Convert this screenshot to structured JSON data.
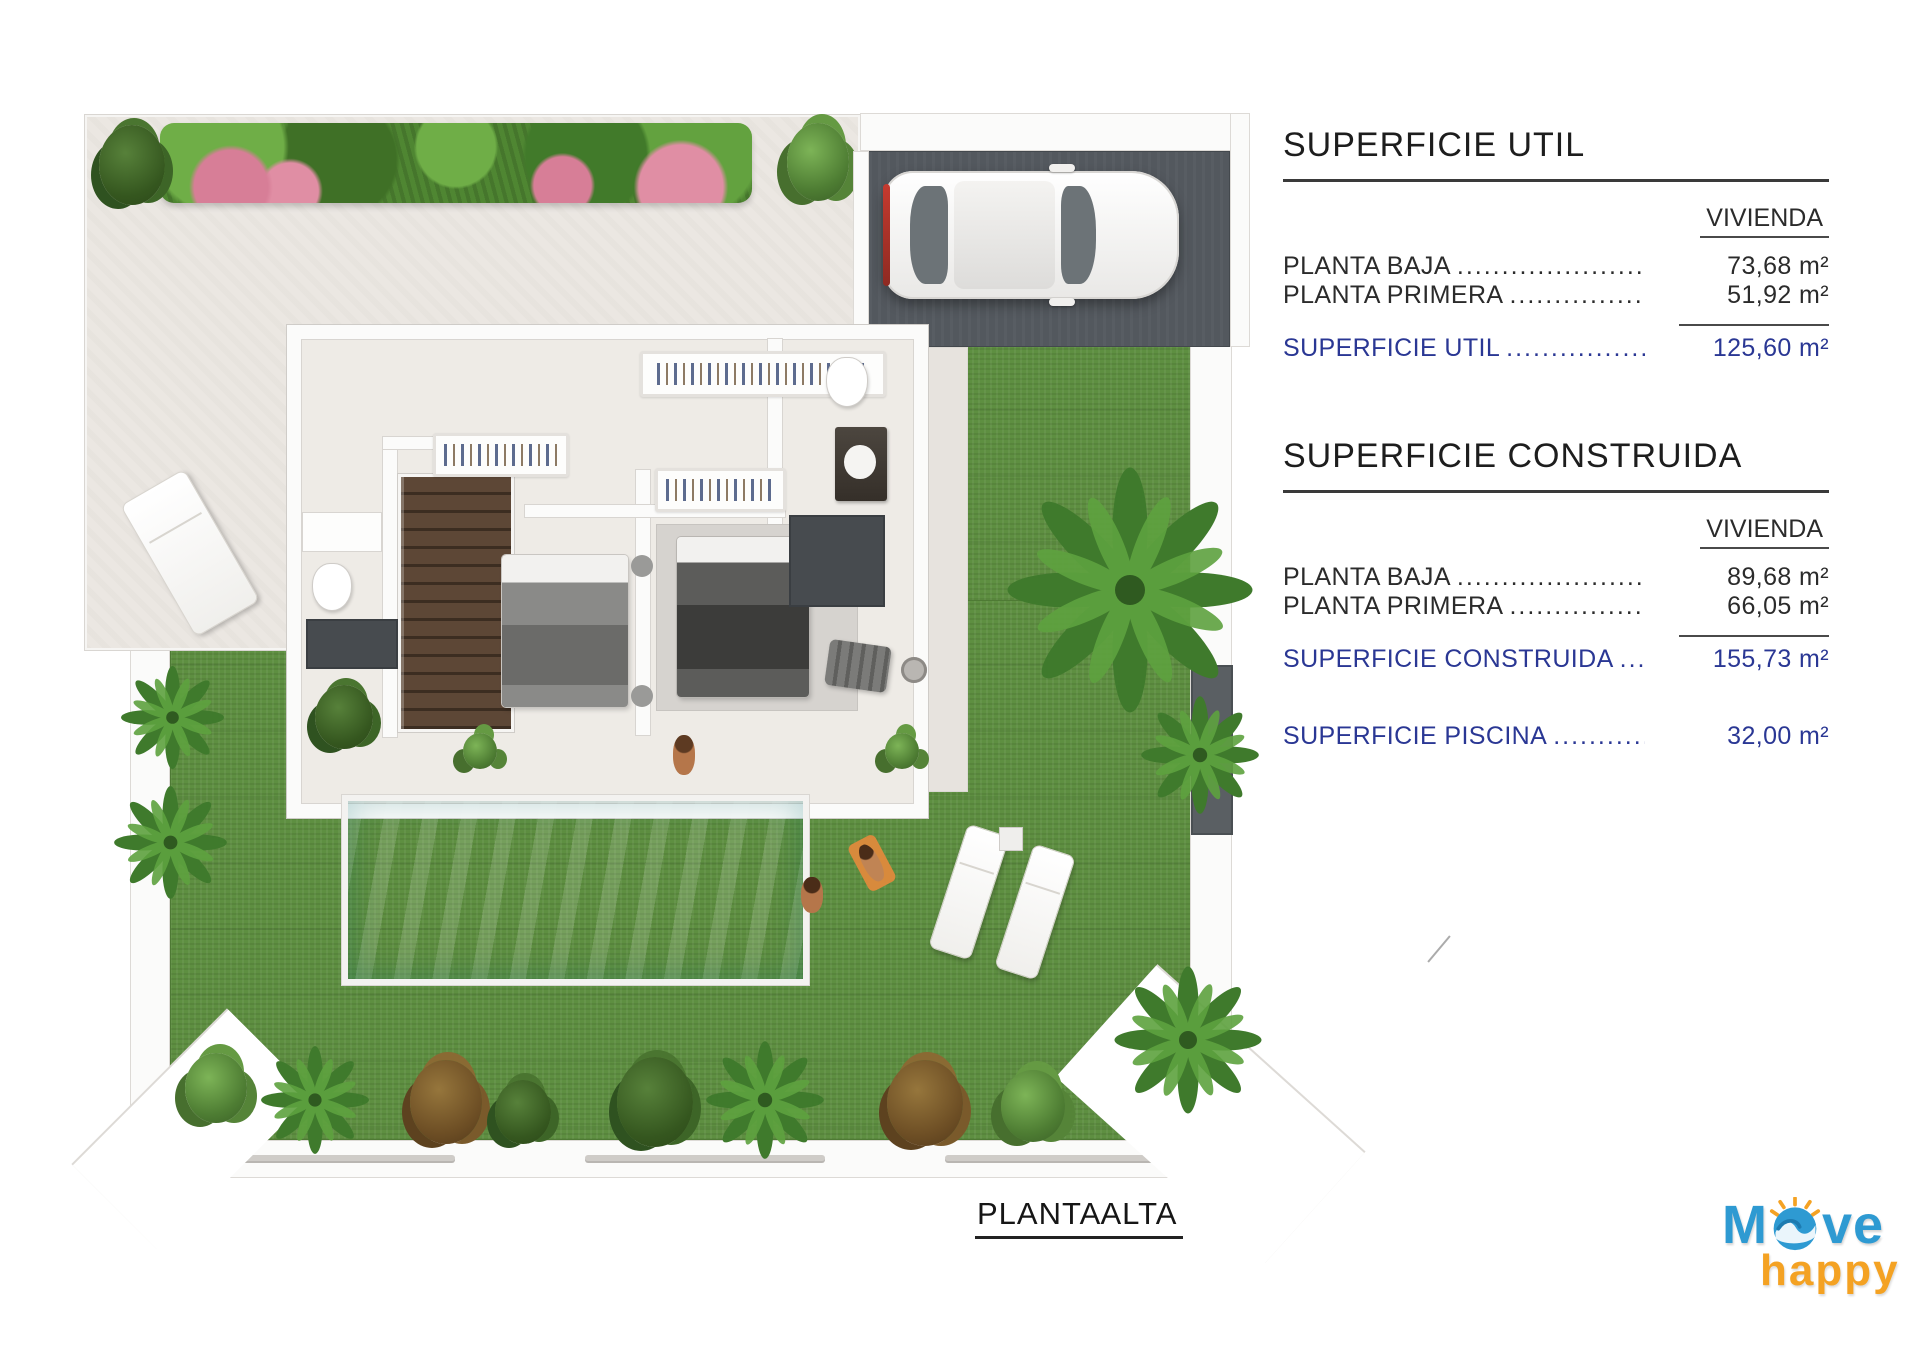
{
  "panel": {
    "section_util": {
      "title": "SUPERFICIE UTIL",
      "col_header": "VIVIENDA",
      "rows": [
        {
          "label": "PLANTA BAJA",
          "dots": "....................................................",
          "value": "73,68 m²"
        },
        {
          "label": "PLANTA PRIMERA",
          "dots": "....................................................",
          "value": "51,92 m²"
        }
      ],
      "total": {
        "label": "SUPERFICIE UTIL",
        "dots": "....................................................",
        "value": "125,60 m²"
      }
    },
    "section_construida": {
      "title": "SUPERFICIE CONSTRUIDA",
      "col_header": "VIVIENDA",
      "rows": [
        {
          "label": "PLANTA BAJA",
          "dots": "....................................................",
          "value": "89,68 m²"
        },
        {
          "label": "PLANTA PRIMERA",
          "dots": "....................................................",
          "value": "66,05 m²"
        }
      ],
      "total": {
        "label": "SUPERFICIE CONSTRUIDA",
        "dots": "....................................................",
        "value": "155,73 m²"
      },
      "total2": {
        "label": "SUPERFICIE  PISCINA",
        "dots": "....................................................",
        "value": "32,00 m²"
      }
    }
  },
  "plan_title": "PLANTA ALTA",
  "logo": {
    "part1": "M",
    "part2": "ve",
    "word2": "happy"
  },
  "colors": {
    "accent_blue_text": "#2a3794",
    "heading_text": "#1d1d1d",
    "grass": "#5e8f41",
    "pool": "#84d5cf",
    "terrace": "#ebe7e2",
    "garage_floor": "#53585e",
    "logo_blue": "#2e9ad2",
    "logo_orange": "#f4a223"
  }
}
